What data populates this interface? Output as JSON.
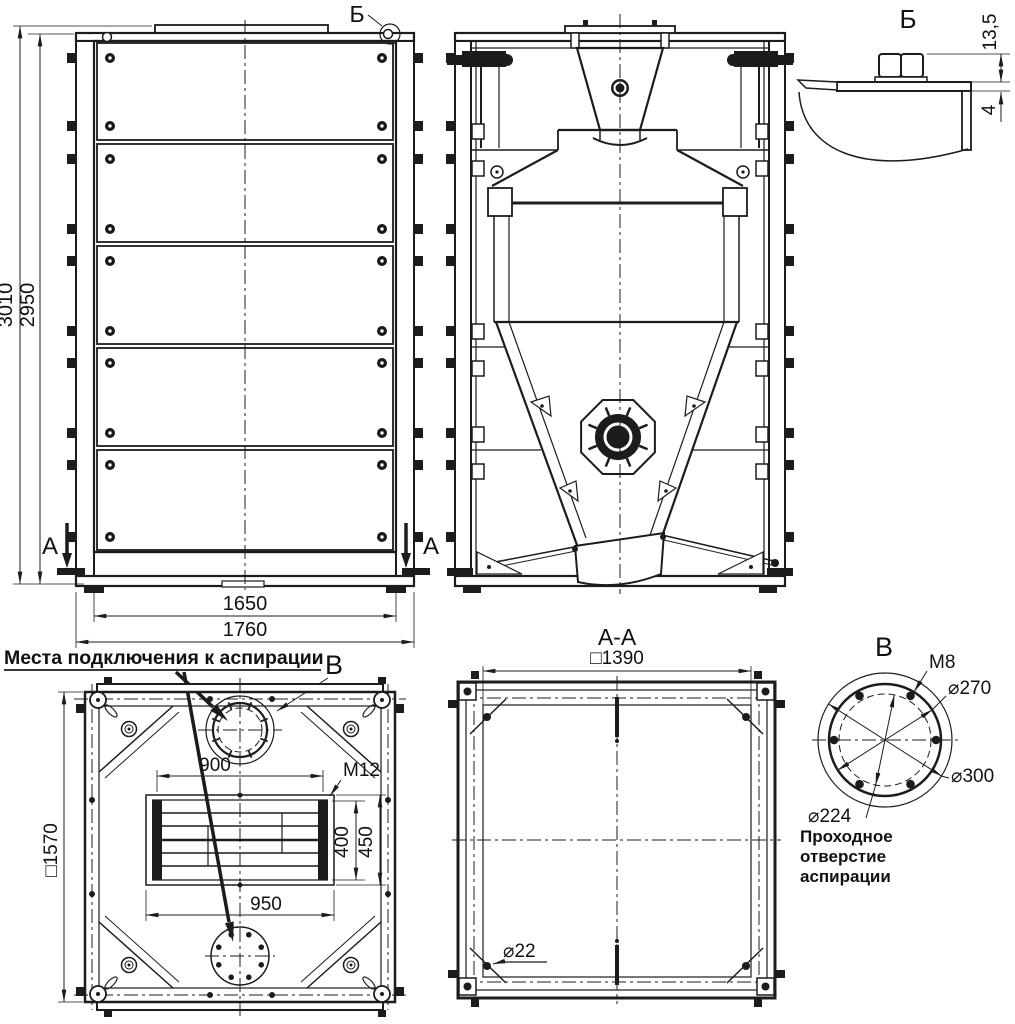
{
  "page": {
    "background": "#ffffff",
    "ink": "#1c1c1c"
  },
  "front_view": {
    "dim_height_total": "3010",
    "dim_height_body": "2950",
    "dim_width_inner": "1650",
    "dim_width_outer": "1760",
    "section_label_left": "А",
    "section_label_right": "А",
    "detail_callout": "Б"
  },
  "detail_b": {
    "title": "Б",
    "dim_head_height": "13,5",
    "dim_sheet_thickness": "4"
  },
  "top_view": {
    "note": "Места подключения к аспирации",
    "detail_callout": "В",
    "dim_square": "□1570",
    "dim_slot_top": "900",
    "thread": "М12",
    "dim_opening_height": "400",
    "dim_frame_height": "450",
    "dim_slot_bottom": "950"
  },
  "section_aa": {
    "title": "А-А",
    "dim_square": "□1390",
    "dim_hole": "⌀22"
  },
  "detail_v": {
    "title": "В",
    "thread": "М8",
    "dim_bolt_circle": "⌀270",
    "dim_outer": "⌀300",
    "dim_passage": "⌀224",
    "note_line1": "Проходное",
    "note_line2": "отверстие",
    "note_line3": "аспирации"
  }
}
